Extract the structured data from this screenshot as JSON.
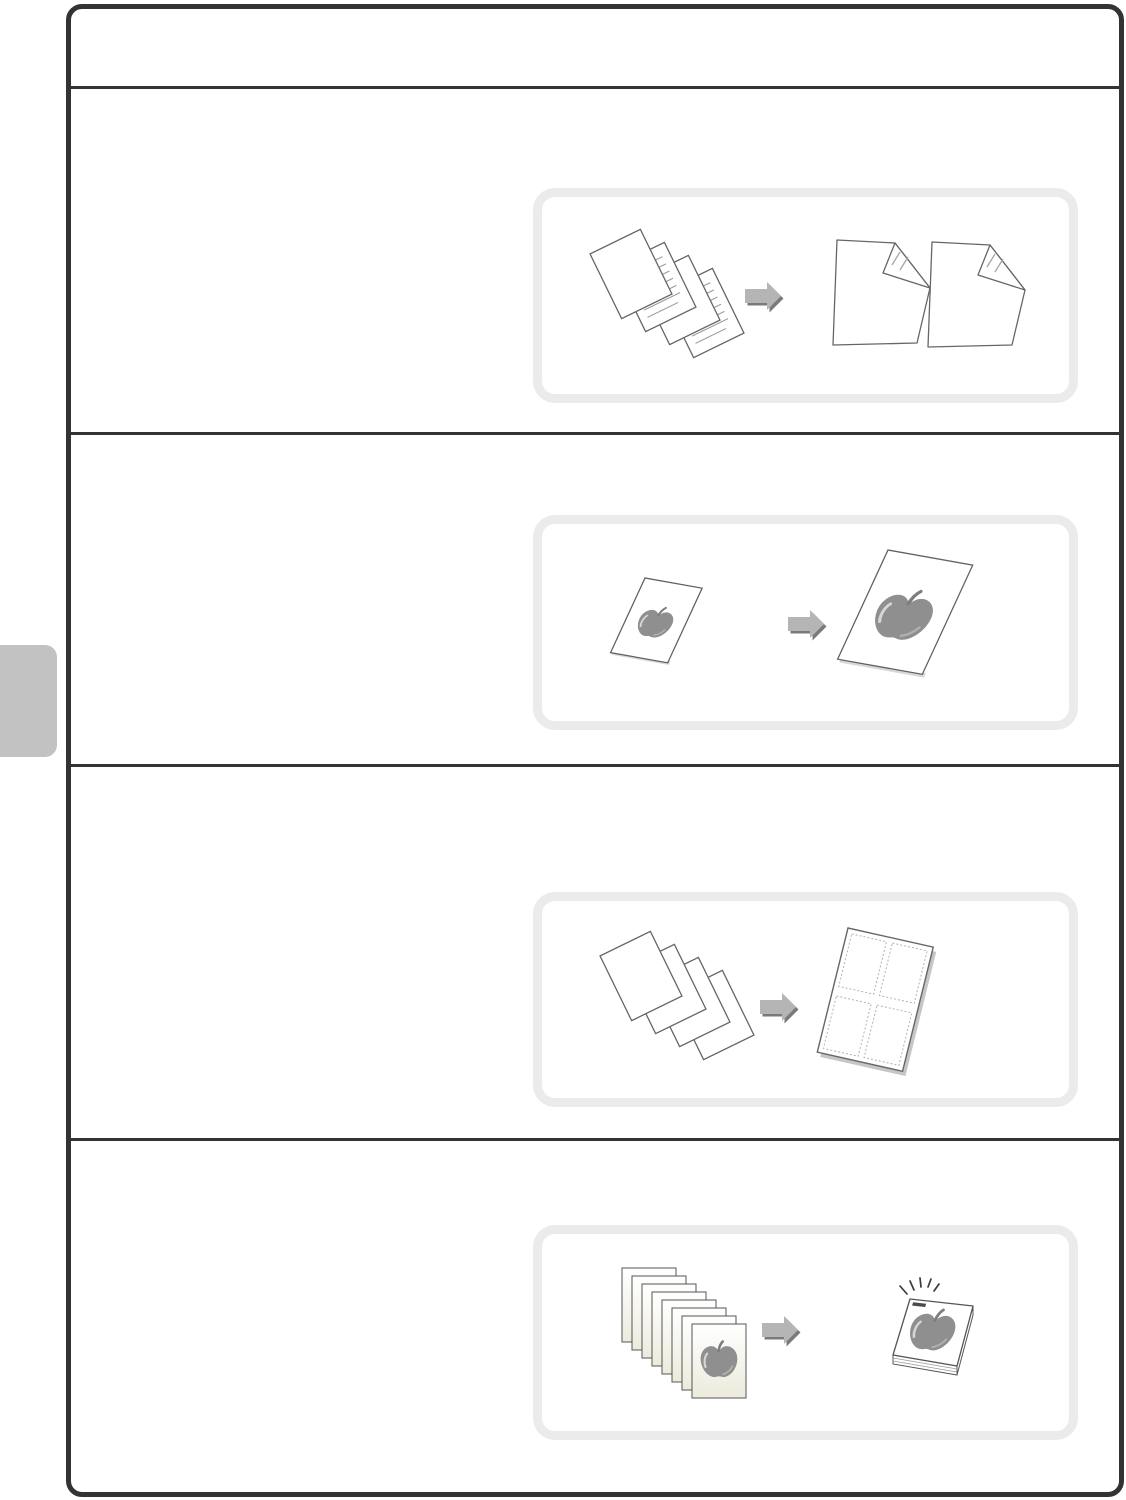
{
  "page": {
    "type": "copier-manual-illustration-page",
    "background_color": "#ffffff",
    "frame_border_color": "#333333",
    "illustration_box_border_color": "#ebebeb",
    "side_tab_color": "#c2c2c2",
    "arrow_color": "#b5b5b5",
    "arrow_shadow_color": "#7a7a7a",
    "artwork_gray": "#8f8f8f",
    "page_outline_color": "#666666",
    "text_line_color": "#9c9c9c",
    "cream_page_color": "#ecebdc"
  },
  "header": {
    "text": ""
  },
  "sections": [
    {
      "name": "two-sided-copying",
      "illustration": {
        "left_icon": "stack-of-four-originals-icon",
        "arrow_icon": "right-arrow-icon",
        "right_icon": "two-sided-copies-folded-corner-icon",
        "original_count": 4
      }
    },
    {
      "name": "enlarged-copy",
      "illustration": {
        "left_icon": "small-apple-original-icon",
        "arrow_icon": "right-arrow-icon",
        "right_icon": "enlarged-apple-copy-icon"
      }
    },
    {
      "name": "multi-shot-four-up",
      "illustration": {
        "left_icon": "stack-of-four-blank-originals-icon",
        "arrow_icon": "right-arrow-icon",
        "right_icon": "four-up-combined-sheet-icon",
        "pages_per_sheet": 4
      }
    },
    {
      "name": "collate-staple",
      "illustration": {
        "left_icon": "stack-of-eight-apple-pages-icon",
        "arrow_icon": "right-arrow-icon",
        "right_icon": "stapled-booklet-icon",
        "original_count": 8
      }
    }
  ]
}
